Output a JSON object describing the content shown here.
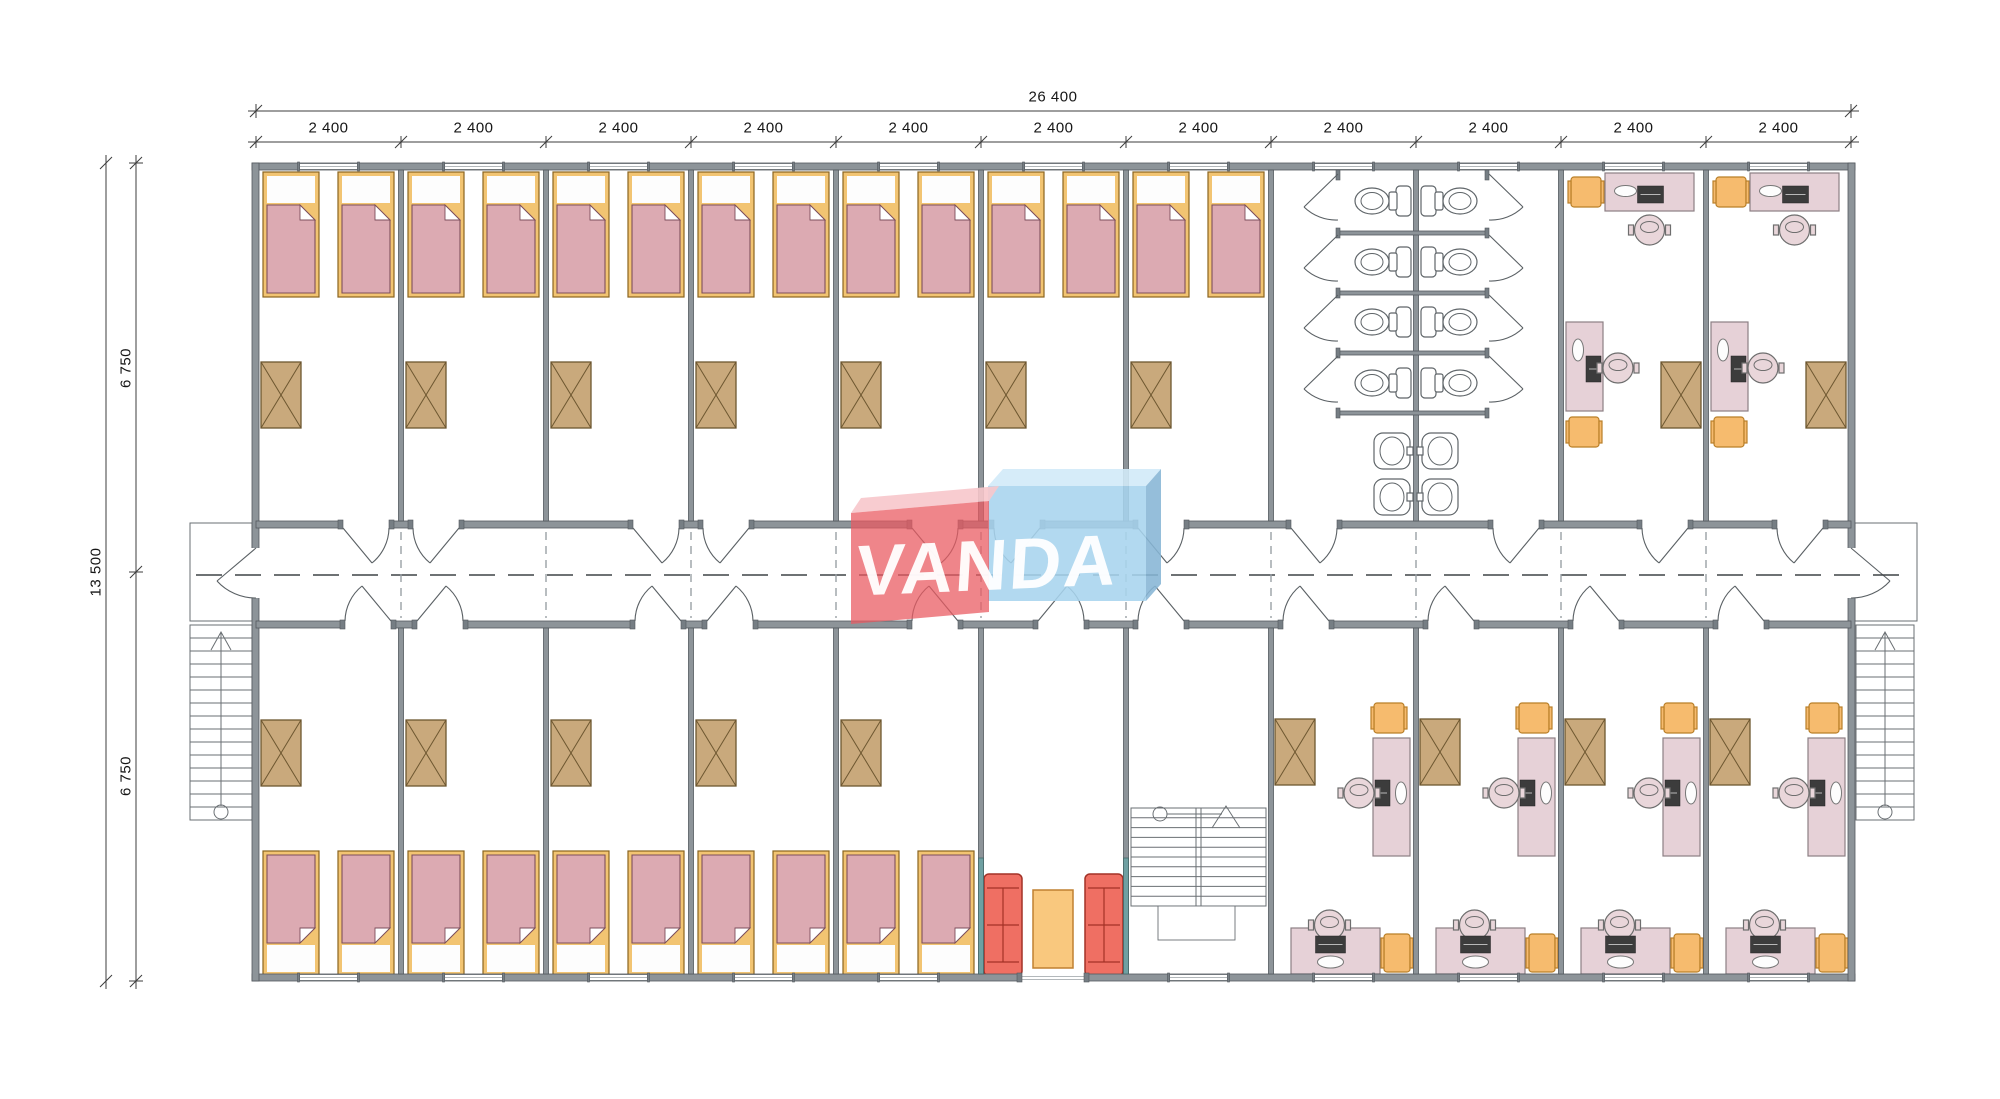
{
  "watermark": {
    "text": "VANDA",
    "red_box_color": "#ea5a61",
    "red_box_top_color": "#f7c6cb",
    "blue_box_color": "#a7d4ee",
    "blue_box_top_color": "#d1eaf8",
    "blue_box_side_color": "#86b5d5",
    "text_color": "#ffffff"
  },
  "dimensions": {
    "total_width_label": "26 400",
    "module_width_label": "2 400",
    "module_count": 11,
    "total_height_label": "13 500",
    "half_height_label": "6 750",
    "half_count": 2
  },
  "plan": {
    "x0": 256,
    "x1": 1851,
    "y_top": 163,
    "y_bottom": 981,
    "wall_ext": 7,
    "wall_int": 5,
    "corridor_top": 521,
    "corridor_bottom": 628,
    "corridor_mid": 575,
    "modules": 11,
    "top_rooms": [
      "bedroom",
      "bedroom",
      "bedroom",
      "bedroom",
      "bedroom",
      "bedroom",
      "bedroom",
      "bathroom",
      "bathroom",
      "office",
      "office"
    ],
    "bottom_rooms": [
      "bedroom",
      "bedroom",
      "bedroom",
      "bedroom",
      "bedroom",
      "lounge",
      "staircase",
      "office",
      "office",
      "office",
      "office"
    ],
    "top_doors": [
      {
        "x": 343,
        "h": "L"
      },
      {
        "x": 413,
        "h": "R"
      },
      {
        "x": 633,
        "h": "L"
      },
      {
        "x": 703,
        "h": "R"
      },
      {
        "x": 912,
        "h": "L"
      },
      {
        "x": 994,
        "h": "R"
      },
      {
        "x": 1138,
        "h": "L"
      },
      {
        "x": 1291,
        "h": "L"
      },
      {
        "x": 1493,
        "h": "R"
      },
      {
        "x": 1642,
        "h": "R"
      },
      {
        "x": 1777,
        "h": "R"
      }
    ],
    "bottom_doors": [
      {
        "x": 345,
        "h": "R"
      },
      {
        "x": 417,
        "h": "L"
      },
      {
        "x": 635,
        "h": "R"
      },
      {
        "x": 707,
        "h": "L"
      },
      {
        "x": 912,
        "h": "R"
      },
      {
        "x": 1038,
        "h": "L"
      },
      {
        "x": 1138,
        "h": "R"
      },
      {
        "x": 1283,
        "h": "R"
      },
      {
        "x": 1428,
        "h": "R"
      },
      {
        "x": 1573,
        "h": "R"
      },
      {
        "x": 1718,
        "h": "R"
      }
    ],
    "door_width": 46,
    "south_entrance": {
      "x0": 1022,
      "x1": 1084
    },
    "toilet_rows": [
      201,
      262,
      322,
      383
    ],
    "sink_rows": [
      433,
      479
    ],
    "stall_partitions": [
      233,
      293,
      353,
      413
    ]
  },
  "furniture_counts": {
    "beds": 24,
    "wardrobes": 18,
    "desks": 12,
    "office_chairs": 12,
    "stools": 12,
    "sofas": 2,
    "coffee_tables": 1,
    "toilets": 8,
    "sinks": 4,
    "interior_staircases": 1,
    "exterior_staircases": 2
  },
  "palette": {
    "wall": "#8d9499",
    "bed_frame": "#f2c472",
    "blanket": "#dcaab2",
    "wardrobe": "#c9a97c",
    "stool": "#f6bb6e",
    "desk": "#e6d1d7",
    "sofa": "#ef6f63",
    "coffee_table": "#f9c87e",
    "teal_accent": "#6fa0a2"
  }
}
